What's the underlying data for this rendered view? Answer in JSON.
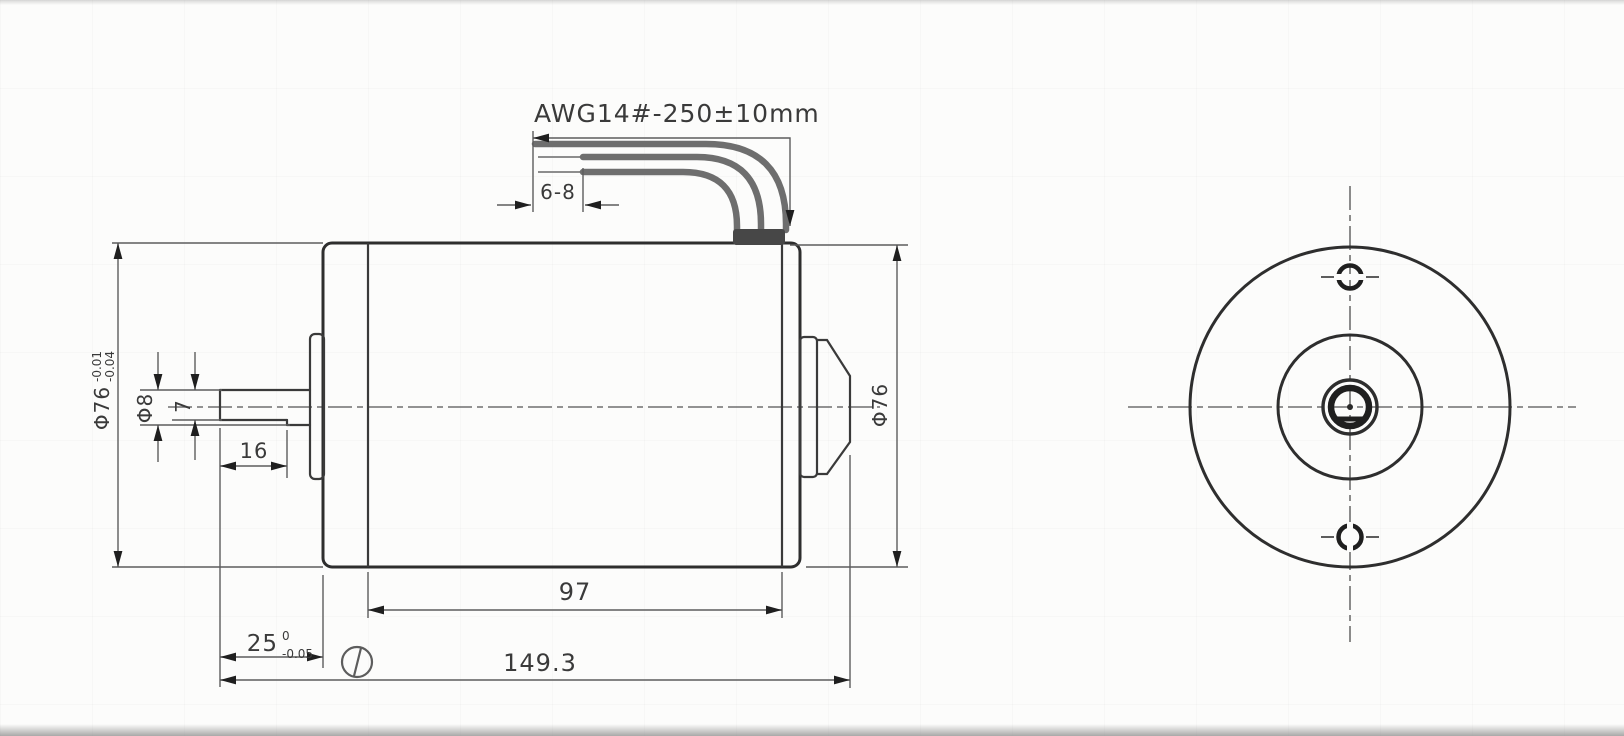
{
  "drawing": {
    "wire_spec": {
      "label": "AWG14#-250±10mm"
    },
    "dims": {
      "strip_length": {
        "label": "6-8"
      },
      "flat_length": {
        "label": "16"
      },
      "shaft_dia": {
        "label": "Φ8"
      },
      "flat_width": {
        "label": "7"
      },
      "body_dia_left": {
        "value": "Φ76",
        "tol_upper": "-0.01",
        "tol_lower": "-0.04"
      },
      "shaft_extension": {
        "value": "25",
        "tol_upper": "0",
        "tol_lower": "-0.05"
      },
      "body_length": {
        "label": "97"
      },
      "overall_length": {
        "label": "149.3"
      },
      "body_dia_right": {
        "label": "Φ76"
      }
    },
    "colors": {
      "object_line": "#2e2e2e",
      "dimension_line": "#5d5d5d",
      "wire": "#6e6e6e",
      "background": "#fcfcfb"
    }
  }
}
